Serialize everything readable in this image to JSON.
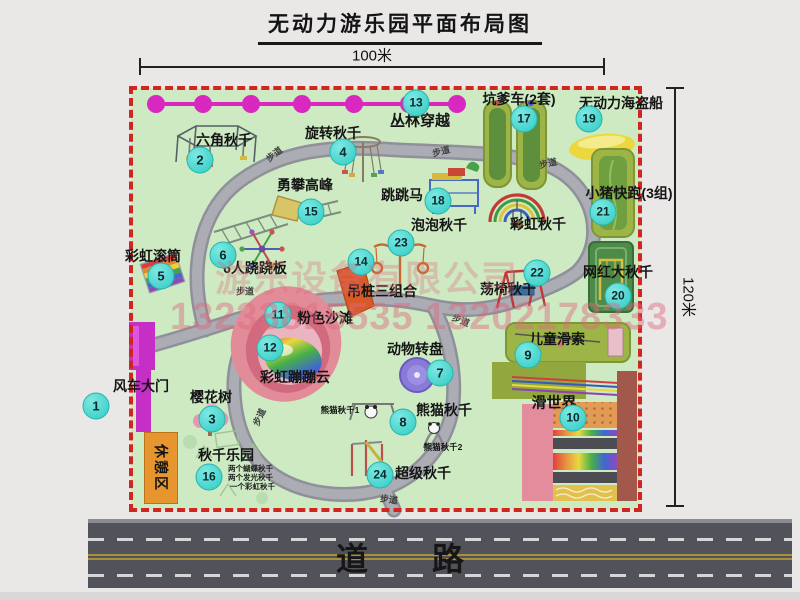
{
  "title": "无动力游乐园平面布局图",
  "dimensions": {
    "width": "100米",
    "height": "120米"
  },
  "road": {
    "char1": "道",
    "char2": "路",
    "full": "道路"
  },
  "path_label": "步道",
  "rest_area_label": "休憩区",
  "watermark": {
    "company": "游乐设备有限公司",
    "phones": "13233815535 13202178333"
  },
  "facilities": [
    {
      "num": "1",
      "label": "风车大门"
    },
    {
      "num": "2",
      "label": "六角秋千"
    },
    {
      "num": "3",
      "label": "樱花树"
    },
    {
      "num": "4",
      "label": "旋转秋千"
    },
    {
      "num": "5",
      "label": "彩虹滚筒"
    },
    {
      "num": "6",
      "label": "6人跷跷板"
    },
    {
      "num": "7",
      "label": "动物转盘"
    },
    {
      "num": "8",
      "label": "熊猫秋千"
    },
    {
      "num": "9",
      "label": "儿童滑索"
    },
    {
      "num": "10",
      "label": "滑世界"
    },
    {
      "num": "11",
      "label": "粉色沙滩"
    },
    {
      "num": "12",
      "label": "彩虹蹦蹦云"
    },
    {
      "num": "13",
      "label": "丛林穿越"
    },
    {
      "num": "14",
      "label": "吊桩三组合"
    },
    {
      "num": "15",
      "label": "勇攀高峰"
    },
    {
      "num": "16",
      "label": "秋千乐园"
    },
    {
      "num": "17",
      "label": "坑爹车(2套)"
    },
    {
      "num": "18",
      "label": "跳跳马"
    },
    {
      "num": "19",
      "label": "无动力海盗船"
    },
    {
      "num": "20",
      "label": "网红大秋千"
    },
    {
      "num": "21",
      "label": "小猪快跑(3组)"
    },
    {
      "num": "22",
      "label": "荡椅秋千"
    },
    {
      "num": "23",
      "label": "泡泡秋千"
    },
    {
      "num": "24",
      "label": "超级秋千"
    }
  ],
  "extra_labels": {
    "rainbow_swing": "彩虹秋千",
    "panda_swing_1": "熊猫秋千1",
    "panda_swing_2": "熊猫秋千2"
  },
  "swing_park_notes": [
    "两个蝴蝶秋千",
    "两个发光秋千",
    "一个彩虹秋千"
  ],
  "colors": {
    "park_green": "#cdeac3",
    "path_gray": "#abacb4",
    "border_red": "#d3251f",
    "marker_teal": "#2fccc4",
    "gate_magenta": "#c62fc6",
    "zipline_magenta": "#d828c0",
    "rest_orange": "#e6952f",
    "road_gray": "#52525b"
  }
}
